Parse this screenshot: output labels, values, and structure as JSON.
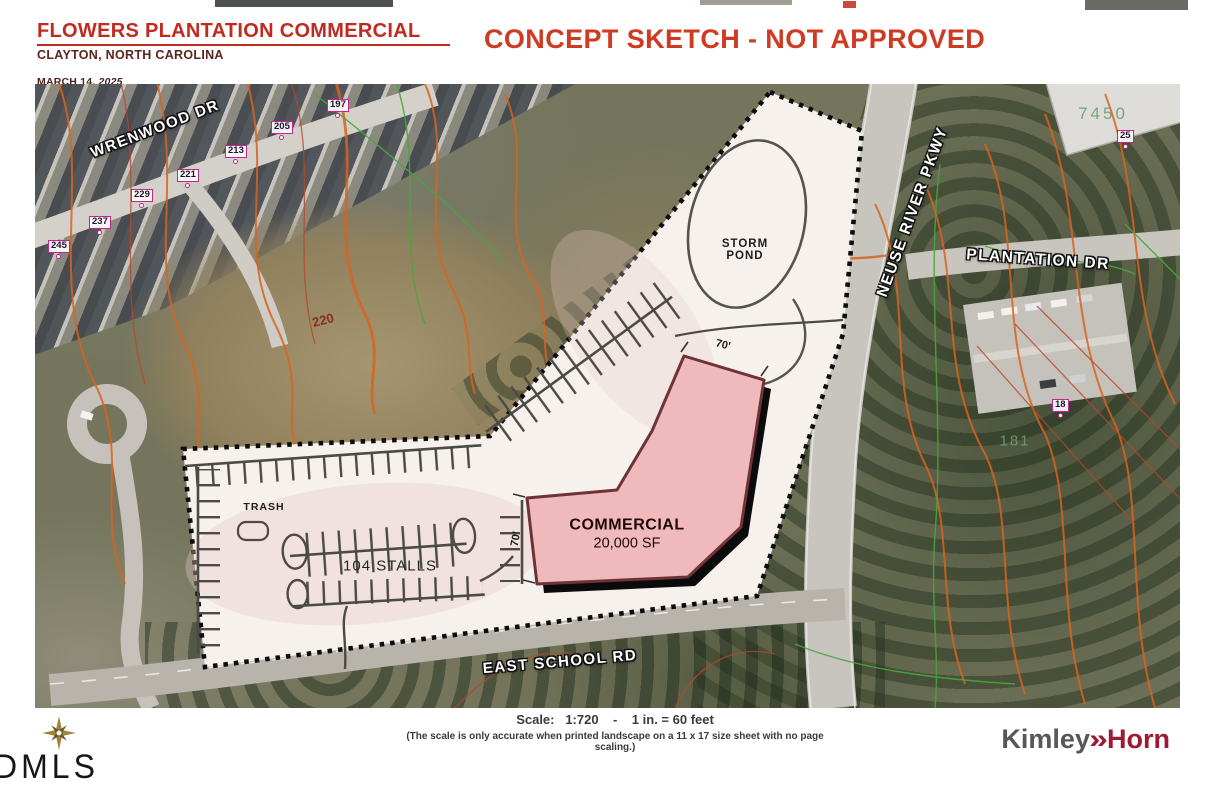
{
  "header": {
    "title": "FLOWERS PLANTATION COMMERCIAL",
    "location": "CLAYTON, NORTH CAROLINA",
    "date_prefix": "MARCH 14, ",
    "date_year": "2025",
    "banner": "CONCEPT SKETCH - NOT APPROVED"
  },
  "map": {
    "road_labels": {
      "wrenwood_dr": "WRENWOOD DR",
      "neuse_river_pkwy": "NEUSE RIVER PKWY",
      "plantation_dr": "PLANTATION DR",
      "east_school_rd": "EAST SCHOOL RD"
    },
    "site_labels": {
      "storm_line1": "STORM",
      "storm_line2": "POND",
      "commercial": "COMMERCIAL",
      "commercial_area": "20,000 SF",
      "stall_count": "104 STALLS",
      "trash": "TRASH",
      "dim_width_top": "70'",
      "dim_width_left": "70'"
    },
    "annotations": {
      "contour_elevation": "220",
      "parcel_7450": "7450",
      "parcel_181": "181"
    },
    "address_markers": [
      "197",
      "205",
      "213",
      "221",
      "229",
      "237",
      "245"
    ],
    "address_markers_right": [
      "25",
      "18"
    ]
  },
  "footer": {
    "scale_text": "Scale:   1:720    -    1 in. = 60 feet",
    "scale_note": "(The scale is only accurate when printed landscape on a 11 x 17 size sheet with no page scaling.)",
    "watermark": "DMLS",
    "logo_kimley": "Kimley",
    "logo_chevron": "»",
    "logo_horn": "Horn"
  },
  "colors": {
    "title_red": "#c02a21",
    "banner_red": "#cf3a22",
    "building_pink": "#f0b9bc",
    "contour_orange": "#d9631f",
    "marker_magenta": "#c0268c",
    "logo_gray": "#55575b",
    "logo_red": "#9c1b30"
  }
}
